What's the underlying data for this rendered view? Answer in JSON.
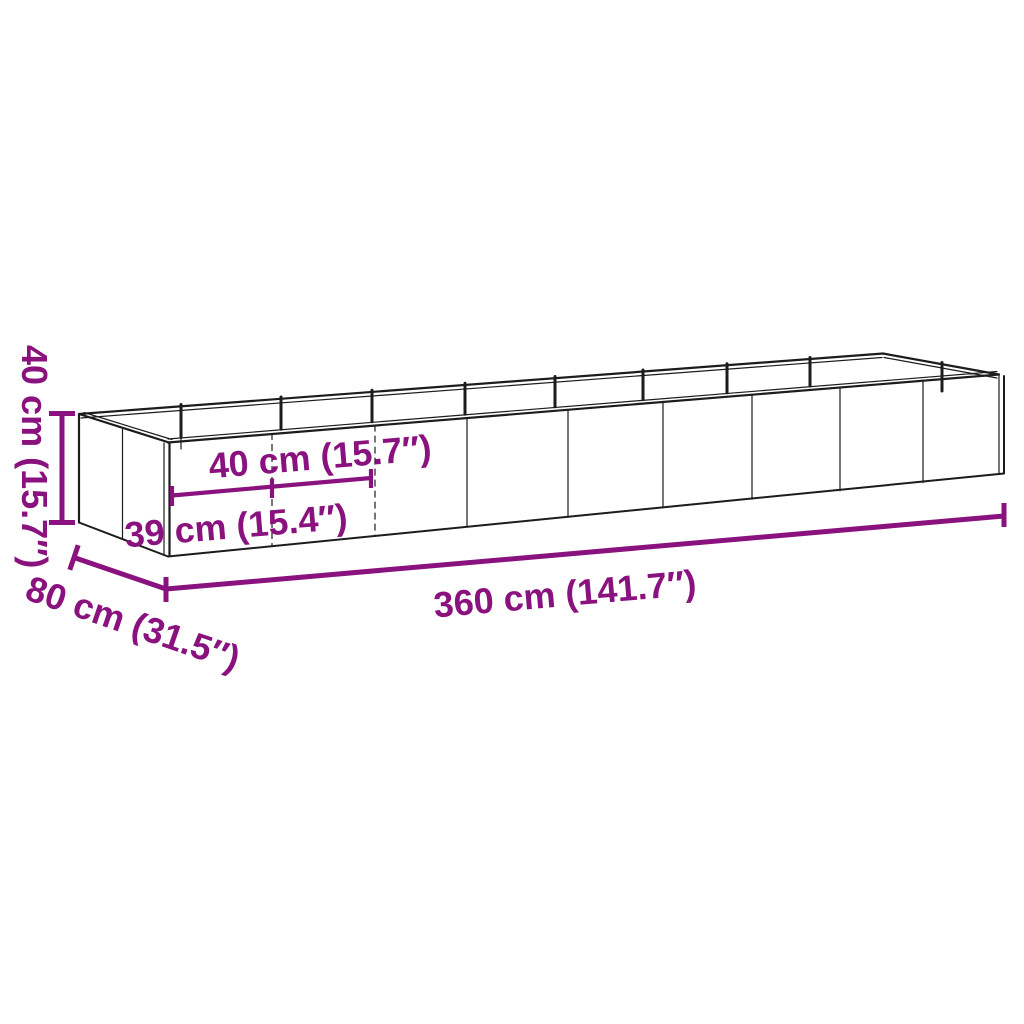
{
  "diagram": {
    "colors": {
      "background": "#ffffff",
      "line_art": "#1c1c1c",
      "dimension": "#8a127e"
    },
    "labels": {
      "height": "40 cm (15.7″)",
      "panel_width": "40 cm (15.7″)",
      "end_panel_width": "39 cm (15.4″)",
      "length": "360 cm (141.7″)",
      "depth": "80 cm (31.5″)"
    }
  }
}
